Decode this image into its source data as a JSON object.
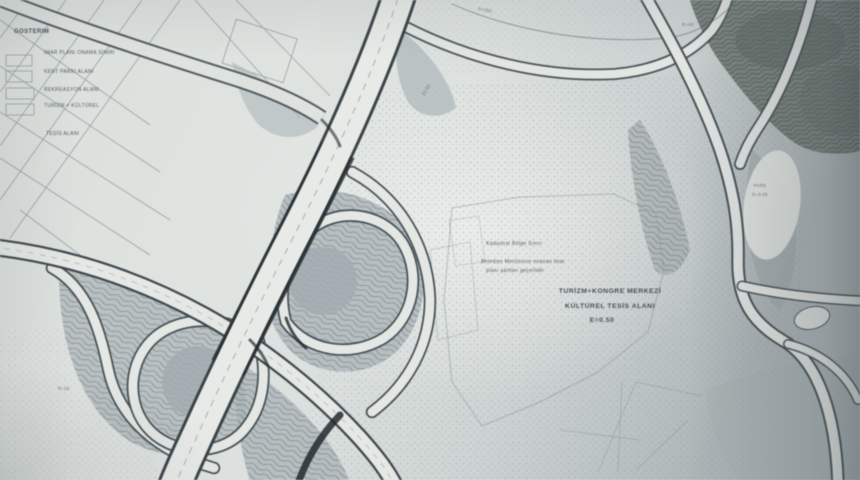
{
  "legend": {
    "title": "GÖSTERİM",
    "items": [
      "İMAR PLANI ONAMA SINIRI",
      "KENT PARKI ALANI",
      "REKREASYON ALANI",
      "TURİZM + KÜLTÜREL",
      "TESİS ALANI"
    ]
  },
  "center_label": {
    "note1": "Kadastral Bölge Sınırı",
    "note2": "Belediye Meclisince onanan imar",
    "note3": "planı şartları geçerlidir",
    "title1": "TURİZM+KONGRE MERKEZİ",
    "title2": "KÜLTÜREL TESİS ALANI",
    "title3": "E=0.50"
  },
  "annotations": [
    "0+250",
    "R=40",
    "PARK",
    "E=0.05",
    "R=25",
    "12.50"
  ],
  "colors": {
    "paper": "#dfe3e1",
    "ink_dark": "#2e353a",
    "ink_mid": "#5a646a",
    "pencil_shade": "#b0b9bc",
    "forest": "#7b847f",
    "text_ink": "#39424b"
  }
}
